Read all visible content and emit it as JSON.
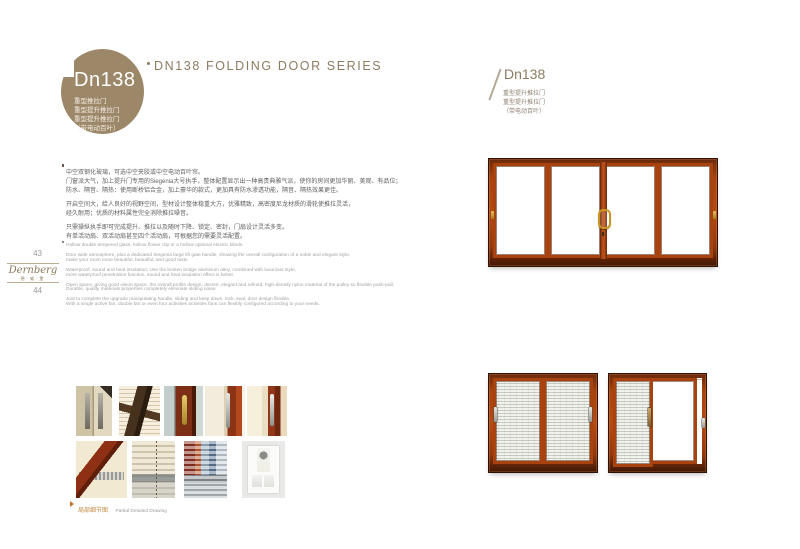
{
  "colors": {
    "badge_taupe": "#9c8768",
    "title_brown": "#8d7b60",
    "wood_red": "#a8430f",
    "gold": "#c9971f",
    "caption_orange": "#c08a3e"
  },
  "left_page": {
    "badge": {
      "model": "Dn138",
      "lines": [
        "重型推拉门",
        "重型提升推拉门",
        "重型提升推拉门",
        "（带电动百叶）"
      ]
    },
    "series_title": "DN138 FOLDING DOOR SERIES",
    "cn_paragraphs": [
      [
        "中空双钢化玻璃，可选中空夹胶或中空电动百叶帘。",
        "门窗派大气，加上提升门专用的Siegenia大号执手，整体配置显示出一种高贵典雅气派，使你的房间更加华丽、美观、有品位；",
        "防水、隔音、隔热：使用断桥铝合金，加上豪华的款式，更加具有防水渗透功能，隔音、隔热效果更佳。"
      ],
      [
        "开启空间大，给人良好的视野空间，型材设计整体稳重大方，优雅精致，高密度尼龙材质的滑轮使推拉灵活，",
        "经久耐用；优质的材料属性完全消除推拉噪音。"
      ],
      [
        "只需操纵执手即可完成提升、推拉以及随时下降、锁定、密封，门扇设计灵活多变。",
        "有单活动扇、双活动扇甚至四个活动扇，可根据您的需要灵活配置。"
      ]
    ],
    "en_paragraphs": [
      [
        "Hollow double tempered glass, hollow flower clip or a hollow optional electric blinds."
      ],
      [
        "Door wide atmosphere, plus a dedicated Siegenia large lift gate handle, showing the overall configuration of a noble and elegant style,",
        "make your room more beautiful, beautiful, and good taste."
      ],
      [
        "Waterproof, sound and heat insulation: Use the broken bridge aluminum alloy, combined with luxurious style,",
        "more waterproof penetration function, sound and heat insulation effect is better."
      ],
      [
        "Open space, giving good vision space, the overall profile design, decent, elegant and refined; high-density nylon material of the pulley so flexible push-pull,",
        "Durable, quality materials properties completely eliminate sliding noise."
      ],
      [
        "Just to complete the upgrade manipulating handle, sliding and keep down, lock, seal, door design flexible,",
        "With a single active fan, double fan or even four activities activities fans can flexibly configured according to your needs."
      ]
    ],
    "spine": {
      "page_number_top": "43",
      "brand": "Dernberg",
      "brand_sub": "德·威·堡",
      "page_number_bottom": "44"
    },
    "gallery": {
      "caption_cn": "局部细节图",
      "caption_en": "Partial Detailed Drawing",
      "photos": [
        "sliding-door-pair-handles",
        "frame-profile-cross-section",
        "gold-curved-handle",
        "long-bar-handle",
        "frame-with-bar-handle",
        "frame-corner-track",
        "venetian-blinds-chain",
        "venetian-blinds-colored",
        "wall-control-panel"
      ]
    }
  },
  "right_page": {
    "model": "Dn138",
    "lines": [
      "重型提升推拉门",
      "重型提升推拉门",
      "（带电动百叶）"
    ]
  }
}
